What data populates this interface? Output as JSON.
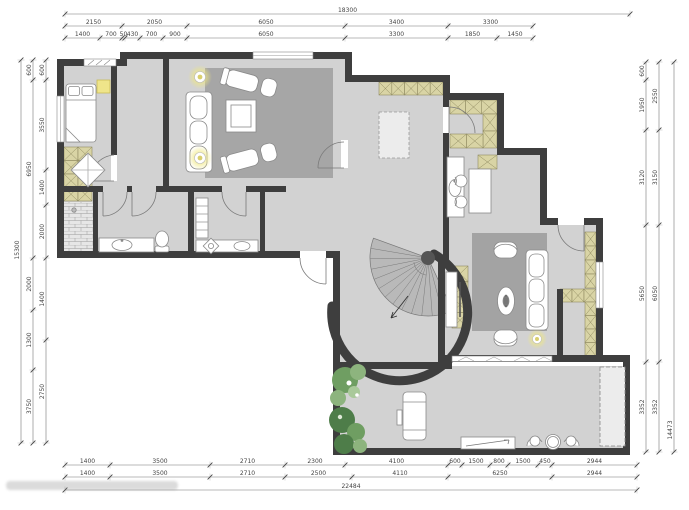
{
  "page": {
    "type": "architectural floor plan drawing",
    "watermark_visible": true,
    "watermark_legible": false
  },
  "colors": {
    "wall": "#3e3e3e",
    "floor": "#d2d2d2",
    "rug": "#a6a6a6",
    "stair_fill": "#b9b9b9",
    "cabinet_hatch_fill": "#d9d4a5",
    "cabinet_hatch_line": "#8f8a60",
    "light_glow": "#f0e87e",
    "plant_dark": "#4e7d49",
    "plant_light": "#8db47e",
    "dimension_text": "#444444",
    "furniture_stroke": "#8a8a8a"
  },
  "dimensions": {
    "top": {
      "total": "18300",
      "row1": [
        "2150",
        "2050",
        "6050",
        "3400",
        "3300"
      ],
      "row2": [
        "1400",
        "700",
        "50",
        "430",
        "700",
        "900",
        "6050",
        "3300",
        "1850",
        "1450"
      ]
    },
    "bottom": {
      "row1": [
        "1400",
        "3500",
        "2710",
        "2300",
        "4100",
        "600",
        "1500",
        "800",
        "1500",
        "450",
        "2944"
      ],
      "row2": [
        "1400",
        "3500",
        "2710",
        "2500",
        "4110",
        "6250",
        "2944"
      ],
      "total": "22484"
    },
    "left": {
      "inner": [
        "600",
        "3550",
        "1400",
        "2000",
        "1400",
        "2750"
      ],
      "mid": [
        "600",
        "6950",
        "2000",
        "1300",
        "3750"
      ],
      "total": "15300"
    },
    "right": {
      "inner": [
        "600",
        "1950",
        "3120",
        "5650",
        "3352"
      ],
      "mid": [
        "2550",
        "3150",
        "6050",
        "3352"
      ],
      "total": "14473"
    }
  }
}
